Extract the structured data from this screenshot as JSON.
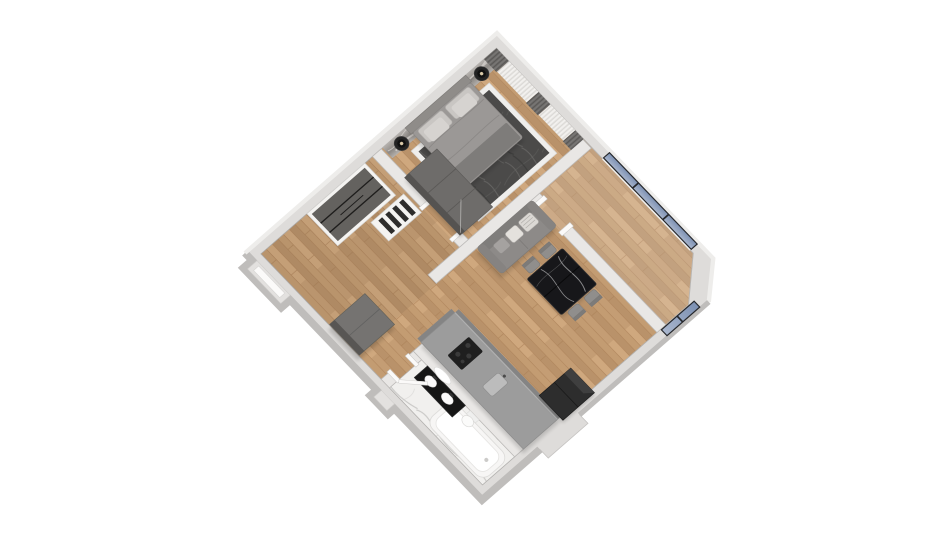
{
  "scene": {
    "title": "3D axonometric floor-plan render of a one-bedroom apartment",
    "view": "top-down 3D render rotated ~45 degrees on white background",
    "page_bg": "#ffffff",
    "colors": {
      "page_bg": "#ffffff",
      "wall_top": "#dedcda",
      "wall_inner_top": "#e9e7e5",
      "wall_outer_shade": "#bfbdbb",
      "wall_outer_light": "#eeedeb",
      "wall_edge": "#b2b0ae",
      "wood_base": "#c39c72",
      "plank_dark": "#a97f55",
      "plank_mid": "#b9926a",
      "plank_light": "#cfa87e",
      "accent_a": "#b5b1ad",
      "accent_b": "#8e8a86",
      "accent_streak": "#d8d4d0",
      "curtain_sheer": "#eceae7",
      "curtain_sheer_pleat": "#d9d7d4",
      "curtain_dark": "#6f6d6b",
      "curtain_dark_pleat": "#585654",
      "glass_a": "#7c90b2",
      "glass_b": "#a9b6cd",
      "frame_dark": "#26282c",
      "rug_dark": "#4b4a49",
      "rug_streak": "#6b6a68",
      "rug_border": "#efeeec",
      "headboard": "#8f8c89",
      "bed_duvet": "#9b9896",
      "bed_throw": "#7e7c7a",
      "bed_pillow": "#c9c6c3",
      "sofa_gray": "#8d8a88",
      "sofa_back": "#7f7d7b",
      "pillow_white": "#dcd9d5",
      "table_black": "#17171a",
      "chair_gray": "#908e8c",
      "counter_gray": "#9c9c9c",
      "counter_side": "#848484",
      "appliance_black": "#2d2d2d",
      "marble_bg": "#f1f0ee",
      "marble_vein": "#c9c8c6",
      "tub_white": "#f7f6f5",
      "vanity_black": "#161616",
      "furniture_dark": "#6e6c6a",
      "furniture_side": "#555351",
      "closet_door": "#64625f",
      "shelf_white": "#f4f3f1",
      "jamb_white": "#fbfaf9"
    },
    "rooms": [
      {
        "id": "bedroom",
        "label": "Bedroom",
        "floor": "wood",
        "position": "top"
      },
      {
        "id": "balcony",
        "label": "Balcony / loggia",
        "floor": "wood",
        "position": "right",
        "features": [
          "panoramic windows"
        ]
      },
      {
        "id": "living-room",
        "label": "Living room",
        "floor": "wood",
        "position": "center"
      },
      {
        "id": "kitchen",
        "label": "Kitchen",
        "floor": "wood",
        "position": "center-right"
      },
      {
        "id": "bathroom",
        "label": "Bathroom",
        "floor": "white marble",
        "position": "bottom"
      },
      {
        "id": "hallway",
        "label": "Hallway / closet",
        "floor": "wood",
        "position": "left"
      }
    ],
    "furniture": [
      {
        "room": "bedroom",
        "items": [
          "textured accent wall",
          "double bed with gray bedding",
          "dark area rug with light border",
          "two black nightstands with table lamps",
          "sheer and dark drapes",
          "tall dark wardrobe"
        ]
      },
      {
        "room": "living-room",
        "items": [
          "gray sofa with white striped pillows",
          "black marble dining table",
          "four gray chairs"
        ]
      },
      {
        "room": "kitchen",
        "items": [
          "gray L-counter",
          "black cooktop",
          "sink",
          "black fridge in niche"
        ]
      },
      {
        "room": "bathroom",
        "items": [
          "white bathtub",
          "black double vanity",
          "oval mirror",
          "toilet",
          "white door"
        ]
      },
      {
        "room": "hallway",
        "items": [
          "sliding-door closet",
          "white shelf unit",
          "gray dresser",
          "entry recess"
        ]
      },
      {
        "room": "balcony",
        "items": [
          "blue glazing with dark mullions",
          "chamfered corner"
        ]
      }
    ]
  }
}
